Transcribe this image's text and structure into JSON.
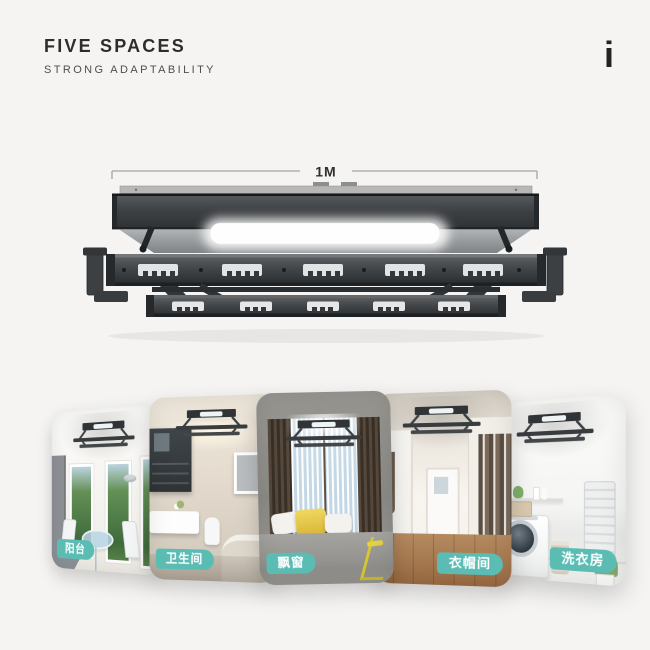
{
  "header": {
    "title": "FIVE SPACES",
    "subtitle": "STRONG ADAPTABILITY",
    "logo_mark": "i"
  },
  "product": {
    "name": "ceiling-drying-rack",
    "dimension_label": "1M"
  },
  "spaces": [
    {
      "label": "阳台"
    },
    {
      "label": "卫生间"
    },
    {
      "label": "飘窗"
    },
    {
      "label": "衣帽间"
    },
    {
      "label": "洗衣房"
    }
  ],
  "colors": {
    "accent_teal": "#5bbcb4",
    "rack_dark": "#35383b",
    "background": "#f5f4f3"
  }
}
